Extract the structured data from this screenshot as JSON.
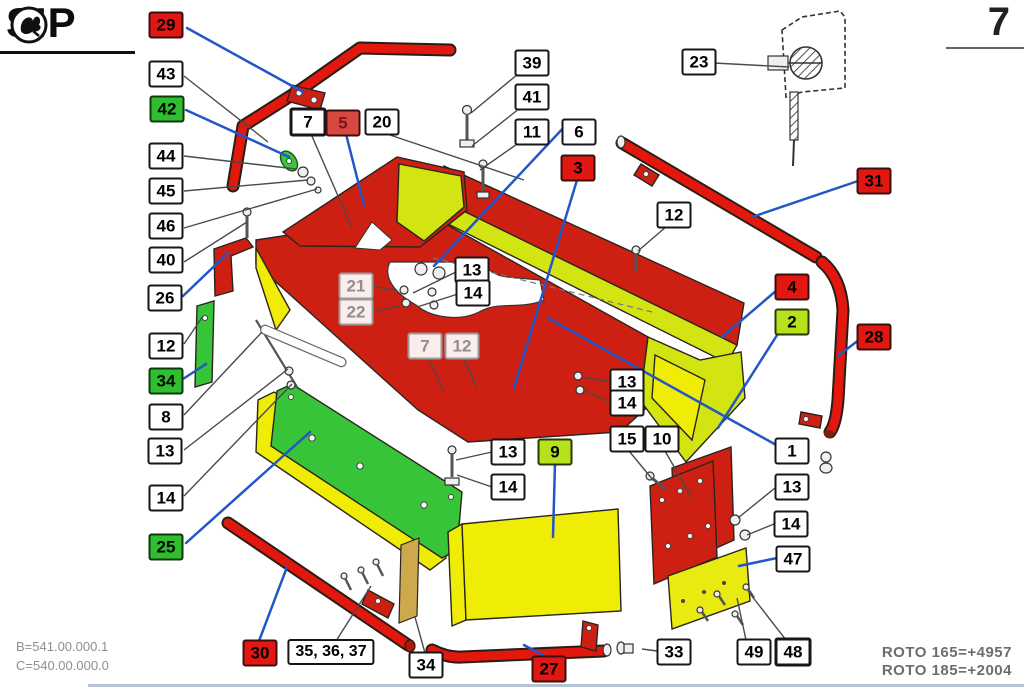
{
  "page": {
    "number": "7"
  },
  "brand": {
    "name": "SIP"
  },
  "footer": {
    "codes": [
      "B=541.00.000.1",
      "C=540.00.000.0"
    ],
    "models": [
      "ROTO 165=+4957",
      "ROTO 185=+2004"
    ]
  },
  "colors": {
    "label_red": "#e31712",
    "label_green": "#2fbe2f",
    "label_chartreuse": "#b6e11d",
    "part_red": "#cd2013",
    "tube_red": "#e2180f",
    "part_yellow": "#efec06",
    "part_chartreuse": "#d2e411",
    "part_green": "#38c438",
    "part_tan": "#cda94e",
    "leader_blue": "#2356c8"
  },
  "labels": [
    {
      "id": "29",
      "text": "29",
      "variant": "red",
      "x": 166,
      "y": 25
    },
    {
      "id": "43",
      "text": "43",
      "variant": "white",
      "x": 166,
      "y": 74
    },
    {
      "id": "42",
      "text": "42",
      "variant": "green",
      "x": 167,
      "y": 109
    },
    {
      "id": "44",
      "text": "44",
      "variant": "white",
      "x": 166,
      "y": 156
    },
    {
      "id": "45",
      "text": "45",
      "variant": "white",
      "x": 166,
      "y": 191
    },
    {
      "id": "46",
      "text": "46",
      "variant": "white",
      "x": 166,
      "y": 226
    },
    {
      "id": "40",
      "text": "40",
      "variant": "white",
      "x": 166,
      "y": 260
    },
    {
      "id": "26",
      "text": "26",
      "variant": "white",
      "x": 165,
      "y": 298
    },
    {
      "id": "12-a",
      "text": "12",
      "variant": "white",
      "x": 166,
      "y": 346
    },
    {
      "id": "34-a",
      "text": "34",
      "variant": "green",
      "x": 166,
      "y": 381
    },
    {
      "id": "8",
      "text": "8",
      "variant": "white",
      "x": 166,
      "y": 417
    },
    {
      "id": "13-a",
      "text": "13",
      "variant": "white",
      "x": 165,
      "y": 451
    },
    {
      "id": "14-a",
      "text": "14",
      "variant": "white",
      "x": 166,
      "y": 498
    },
    {
      "id": "25",
      "text": "25",
      "variant": "green",
      "x": 166,
      "y": 547
    },
    {
      "id": "7-a",
      "text": "7",
      "variant": "white-bold",
      "x": 308,
      "y": 122
    },
    {
      "id": "5",
      "text": "5",
      "variant": "red-muted",
      "x": 343,
      "y": 123
    },
    {
      "id": "20",
      "text": "20",
      "variant": "white",
      "x": 382,
      "y": 122
    },
    {
      "id": "39",
      "text": "39",
      "variant": "white",
      "x": 532,
      "y": 63
    },
    {
      "id": "41",
      "text": "41",
      "variant": "white",
      "x": 532,
      "y": 97
    },
    {
      "id": "11",
      "text": "11",
      "variant": "white",
      "x": 532,
      "y": 132
    },
    {
      "id": "6",
      "text": "6",
      "variant": "white",
      "x": 579,
      "y": 132
    },
    {
      "id": "3",
      "text": "3",
      "variant": "red",
      "x": 578,
      "y": 168
    },
    {
      "id": "23",
      "text": "23",
      "variant": "white",
      "x": 699,
      "y": 62
    },
    {
      "id": "12-b",
      "text": "12",
      "variant": "white",
      "x": 674,
      "y": 215
    },
    {
      "id": "31",
      "text": "31",
      "variant": "red",
      "x": 874,
      "y": 181
    },
    {
      "id": "21",
      "text": "21",
      "variant": "ghost",
      "x": 356,
      "y": 286
    },
    {
      "id": "22",
      "text": "22",
      "variant": "ghost",
      "x": 356,
      "y": 312
    },
    {
      "id": "13-b",
      "text": "13",
      "variant": "white",
      "x": 472,
      "y": 270
    },
    {
      "id": "14-b",
      "text": "14",
      "variant": "white",
      "x": 473,
      "y": 293
    },
    {
      "id": "7-b",
      "text": "7",
      "variant": "ghost",
      "x": 425,
      "y": 346
    },
    {
      "id": "12-c",
      "text": "12",
      "variant": "ghost",
      "x": 462,
      "y": 346
    },
    {
      "id": "4",
      "text": "4",
      "variant": "red",
      "x": 792,
      "y": 287
    },
    {
      "id": "2",
      "text": "2",
      "variant": "chartreuse",
      "x": 792,
      "y": 322
    },
    {
      "id": "28",
      "text": "28",
      "variant": "red",
      "x": 874,
      "y": 337
    },
    {
      "id": "13-c",
      "text": "13",
      "variant": "white",
      "x": 627,
      "y": 382
    },
    {
      "id": "14-c",
      "text": "14",
      "variant": "white",
      "x": 627,
      "y": 403
    },
    {
      "id": "15",
      "text": "15",
      "variant": "white",
      "x": 627,
      "y": 439
    },
    {
      "id": "10",
      "text": "10",
      "variant": "white",
      "x": 662,
      "y": 439
    },
    {
      "id": "1",
      "text": "1",
      "variant": "white",
      "x": 792,
      "y": 451
    },
    {
      "id": "13-d",
      "text": "13",
      "variant": "white",
      "x": 792,
      "y": 487
    },
    {
      "id": "14-d",
      "text": "14",
      "variant": "white",
      "x": 791,
      "y": 524
    },
    {
      "id": "47",
      "text": "47",
      "variant": "white",
      "x": 793,
      "y": 559
    },
    {
      "id": "13-e",
      "text": "13",
      "variant": "white",
      "x": 508,
      "y": 452
    },
    {
      "id": "14-e",
      "text": "14",
      "variant": "white",
      "x": 508,
      "y": 487
    },
    {
      "id": "9",
      "text": "9",
      "variant": "chartreuse",
      "x": 555,
      "y": 452
    },
    {
      "id": "30",
      "text": "30",
      "variant": "red",
      "x": 260,
      "y": 653
    },
    {
      "id": "35-36-37",
      "text": "35, 36, 37",
      "variant": "white-wide",
      "x": 331,
      "y": 652
    },
    {
      "id": "34-b",
      "text": "34",
      "variant": "white",
      "x": 426,
      "y": 665
    },
    {
      "id": "27",
      "text": "27",
      "variant": "red",
      "x": 549,
      "y": 669
    },
    {
      "id": "33",
      "text": "33",
      "variant": "white",
      "x": 674,
      "y": 652
    },
    {
      "id": "49",
      "text": "49",
      "variant": "white",
      "x": 754,
      "y": 652
    },
    {
      "id": "48",
      "text": "48",
      "variant": "white-bold",
      "x": 793,
      "y": 652
    }
  ]
}
